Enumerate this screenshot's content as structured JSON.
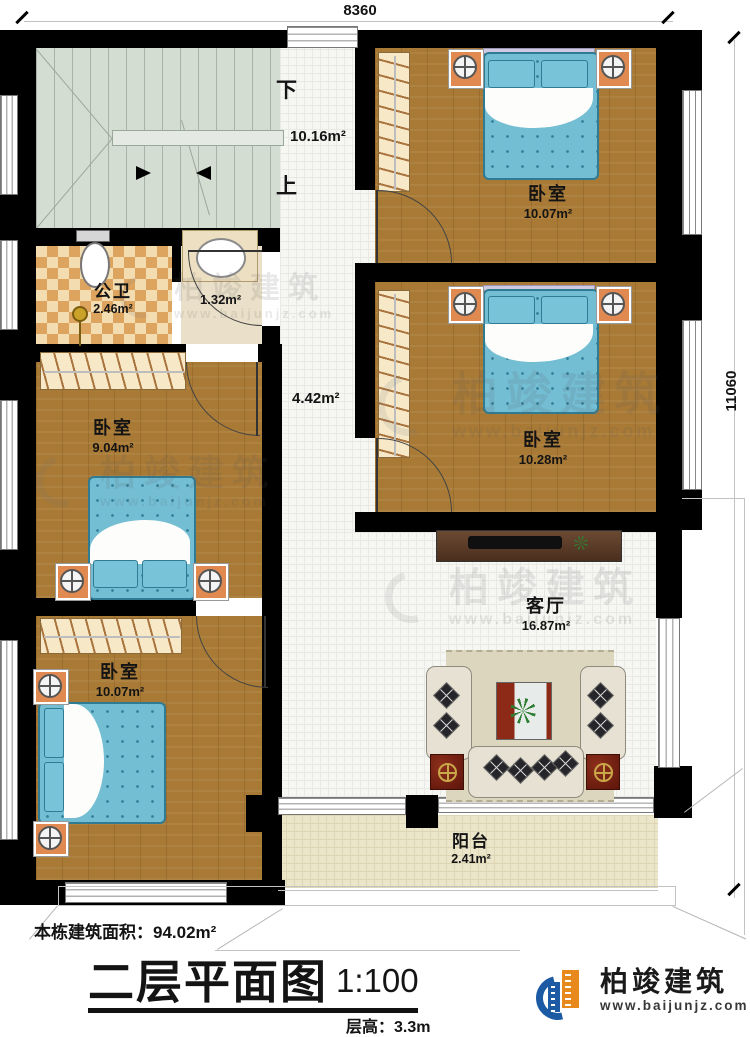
{
  "dimensions": {
    "top": "8360",
    "right": "11060"
  },
  "stairwell": {
    "down_label": "下",
    "up_label": "上",
    "area": "10.16m²"
  },
  "hallway": {
    "area": "4.42m²"
  },
  "bathroom": {
    "name": "公卫",
    "area": "2.46m²"
  },
  "vanity": {
    "area": "1.32m²"
  },
  "bedrooms": {
    "top_right": {
      "name": "卧室",
      "area": "10.07m²"
    },
    "mid_right": {
      "name": "卧室",
      "area": "10.28m²"
    },
    "mid_left": {
      "name": "卧室",
      "area": "9.04m²"
    },
    "bottom_left": {
      "name": "卧室",
      "area": "10.07m²"
    }
  },
  "living_room": {
    "name": "客厅",
    "area": "16.87m²"
  },
  "balcony": {
    "name": "阳台",
    "area": "2.41m²"
  },
  "footer": {
    "building_area": "本栋建筑面积：94.02m²",
    "plan_title": "二层平面图",
    "scale": "1:100",
    "floor_height": "层高：3.3m"
  },
  "brand": {
    "name": "柏竣建筑",
    "url": "www.baijunjz.com"
  },
  "watermark": {
    "name": "柏竣建筑",
    "url": "www.baijunjz.com"
  },
  "colors": {
    "wall": "#000000",
    "wood_floor": "#a97a35",
    "stair_floor": "#d4ddd2",
    "tile_floor": "#f6f6f3",
    "bath_tile_light": "#f3ddb0",
    "bath_tile_dark": "#dca45f",
    "balcony_floor": "#ebe5ca",
    "bed_fabric": "#74bed4",
    "brand_blue": "#1c5ba3",
    "brand_orange": "#e8891d"
  }
}
